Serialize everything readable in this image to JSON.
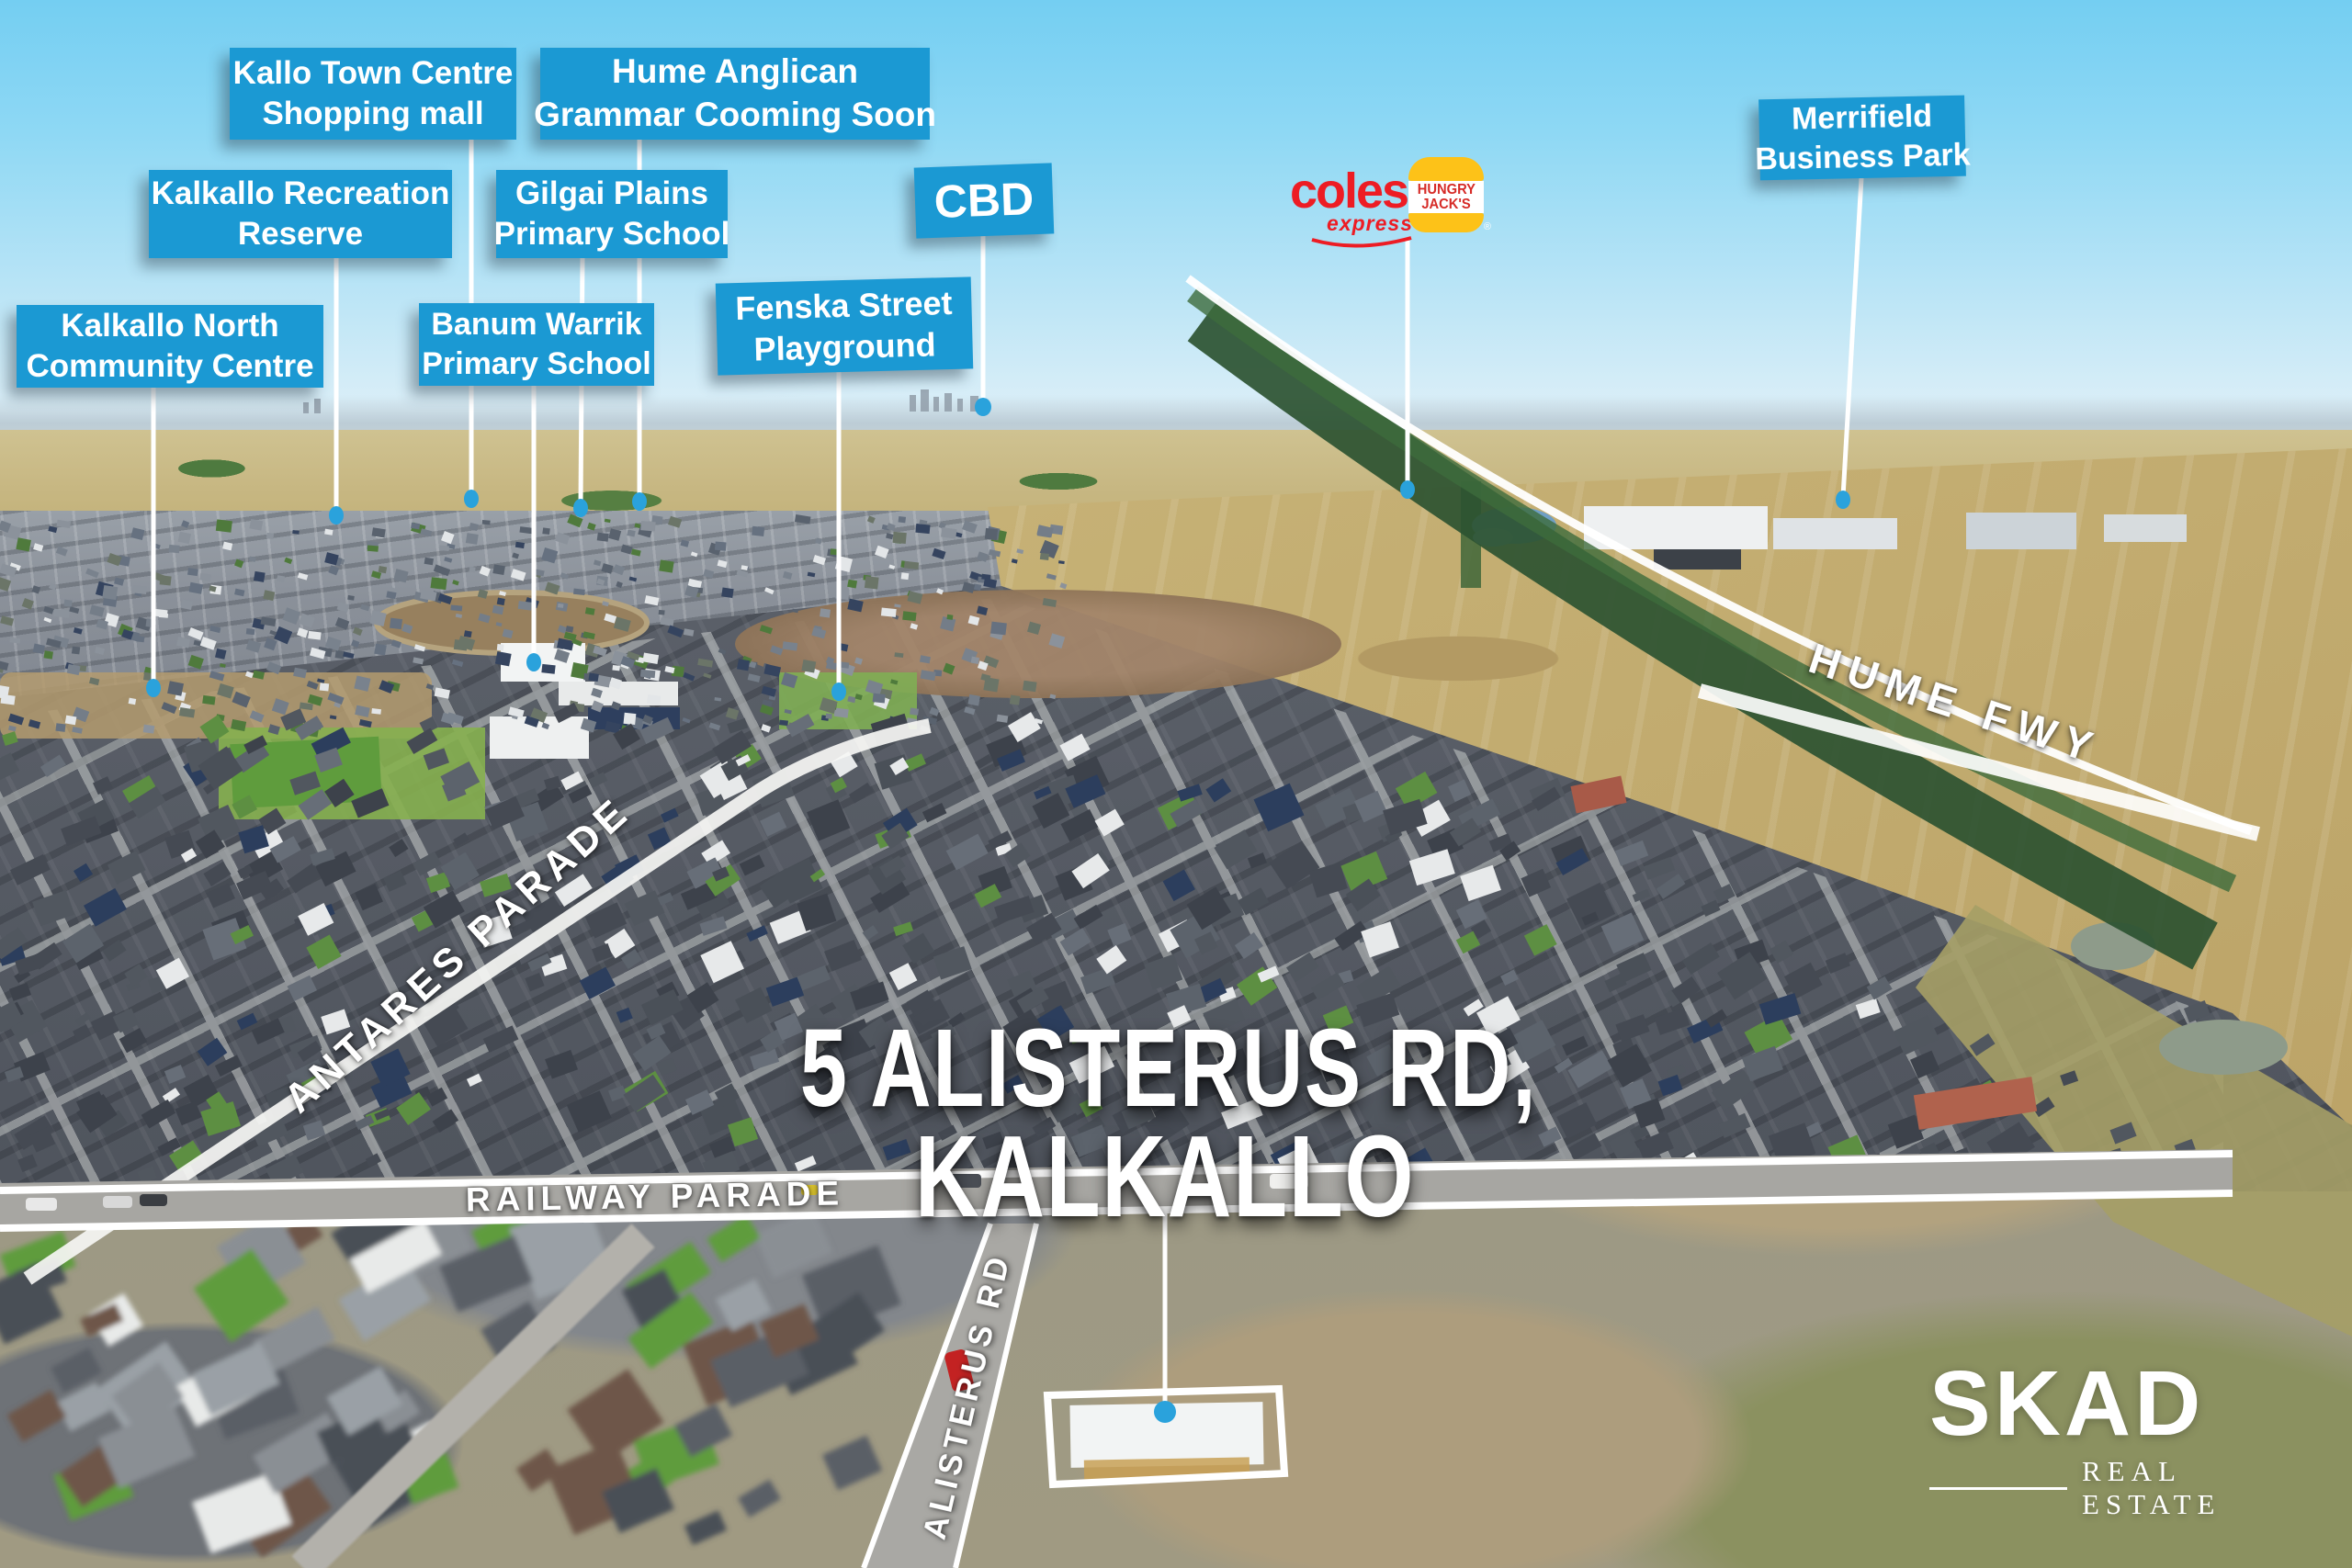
{
  "title": {
    "line1": "5 ALISTERUS RD,",
    "line2": "KALKALLO"
  },
  "callouts": {
    "kallo_town_centre": {
      "line1": "Kallo Town Centre",
      "line2": "Shopping mall"
    },
    "hume_anglican": {
      "line1": "Hume Anglican",
      "line2": "Grammar Cooming Soon"
    },
    "kalkallo_recreation": {
      "line1": "Kalkallo Recreation",
      "line2": "Reserve"
    },
    "gilgai_plains": {
      "line1": "Gilgai Plains",
      "line2": "Primary School"
    },
    "kalkallo_north": {
      "line1": "Kalkallo North",
      "line2": "Community Centre"
    },
    "banum_warrik": {
      "line1": "Banum Warrik",
      "line2": "Primary School"
    },
    "fenska": {
      "line1": "Fenska Street",
      "line2": "Playground"
    },
    "cbd": {
      "line1": "CBD"
    },
    "merrifield": {
      "line1": "Merrifield",
      "line2": "Business Park"
    }
  },
  "roads": {
    "antares": "ANTARES PARADE",
    "railway": "RAILWAY PARADE",
    "alisterus": "ALISTERUS RD",
    "hume": "HUME FWY"
  },
  "logos": {
    "coles": {
      "name": "coles",
      "sub": "express"
    },
    "hungry_jacks": {
      "line1": "HUNGRY",
      "line2": "JACK'S",
      "reg": "®"
    }
  },
  "brand": {
    "name": "SKAD",
    "tagline": "REAL ESTATE"
  },
  "colors": {
    "callout_blue": "#1b99d3",
    "dot_blue": "#2aa2dc",
    "coles_red": "#ed1c24",
    "hj_red": "#d62b27",
    "hj_yellow": "#fdc218",
    "road_highlight": "#ffffff"
  }
}
